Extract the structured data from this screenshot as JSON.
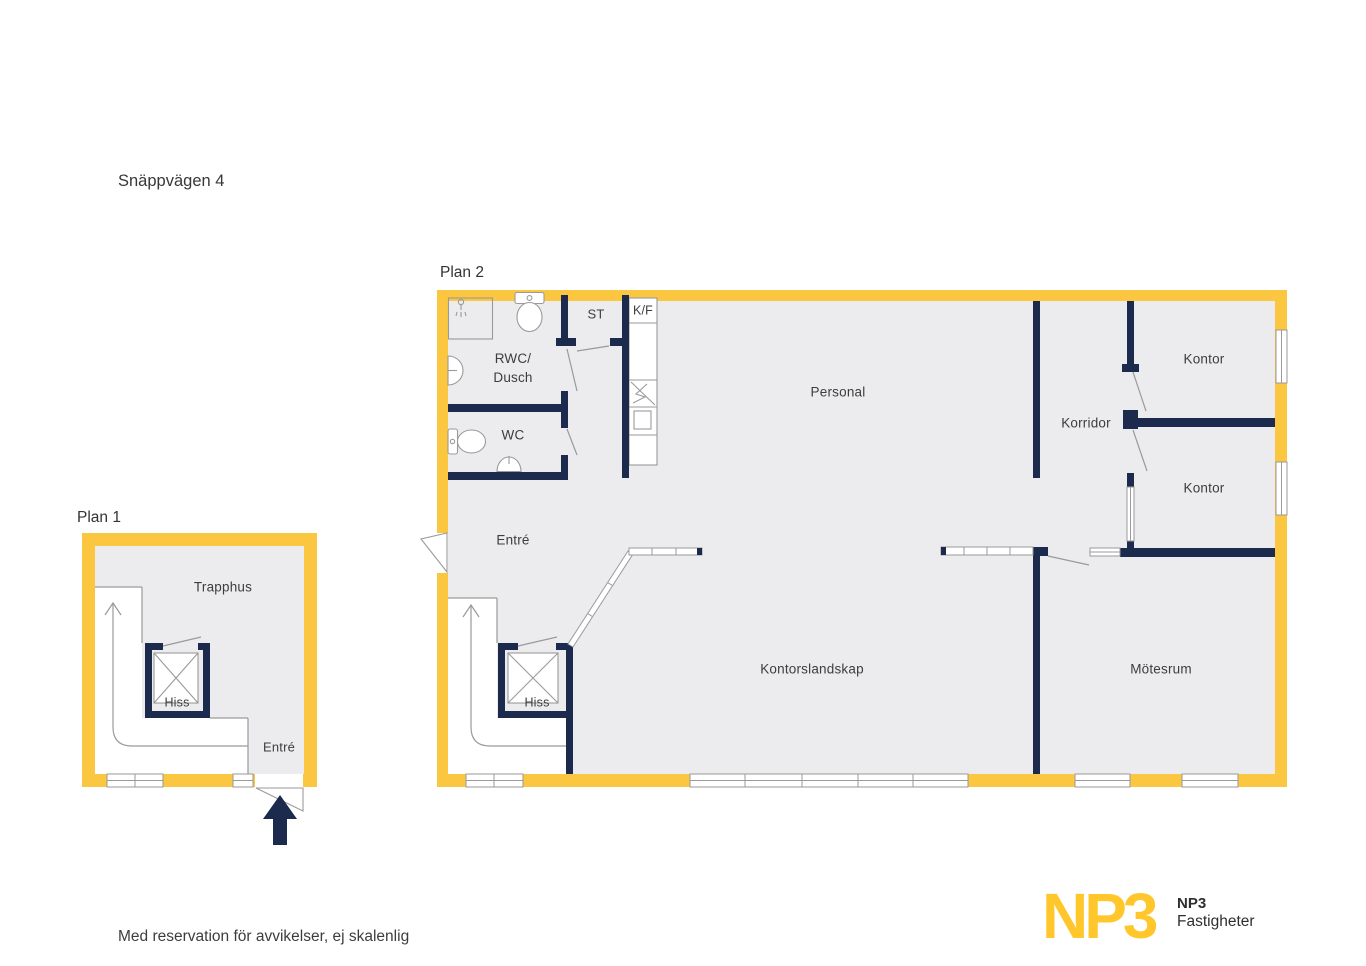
{
  "title": "Snäppvägen 4",
  "disclaimer": "Med reservation för avvikelser, ej skalenlig",
  "plan1": {
    "label": "Plan 1",
    "rooms": {
      "trapphus": {
        "label": "Trapphus"
      },
      "hiss": {
        "label": "Hiss"
      },
      "entre": {
        "label": "Entré"
      }
    }
  },
  "plan2": {
    "label": "Plan 2",
    "rooms": {
      "rwc_dusch": {
        "label": "RWC/\nDusch"
      },
      "st": {
        "label": "ST"
      },
      "kf": {
        "label": "K/F"
      },
      "wc": {
        "label": "WC"
      },
      "personal": {
        "label": "Personal"
      },
      "entre": {
        "label": "Entré"
      },
      "korridor": {
        "label": "Korridor"
      },
      "kontor_1": {
        "label": "Kontor"
      },
      "kontor_2": {
        "label": "Kontor"
      },
      "kontorslandskap": {
        "label": "Kontorslandskap"
      },
      "motesrum": {
        "label": "Mötesrum"
      },
      "hiss": {
        "label": "Hiss"
      }
    }
  },
  "logo": {
    "wordmark": "NP3",
    "name": "NP3",
    "subtitle": "Fastigheter"
  },
  "icons": {
    "entrance_arrow": "arrow-up",
    "stair_direction": "arrow-up"
  },
  "colors": {
    "wall_yellow": "#FBC740",
    "wall_navy": "#1C2B4D",
    "floor_gray": "#ECECEE",
    "line_gray": "#9A9A9A",
    "logo_yellow": "#FFC72C",
    "text": "#3D3D3D"
  }
}
